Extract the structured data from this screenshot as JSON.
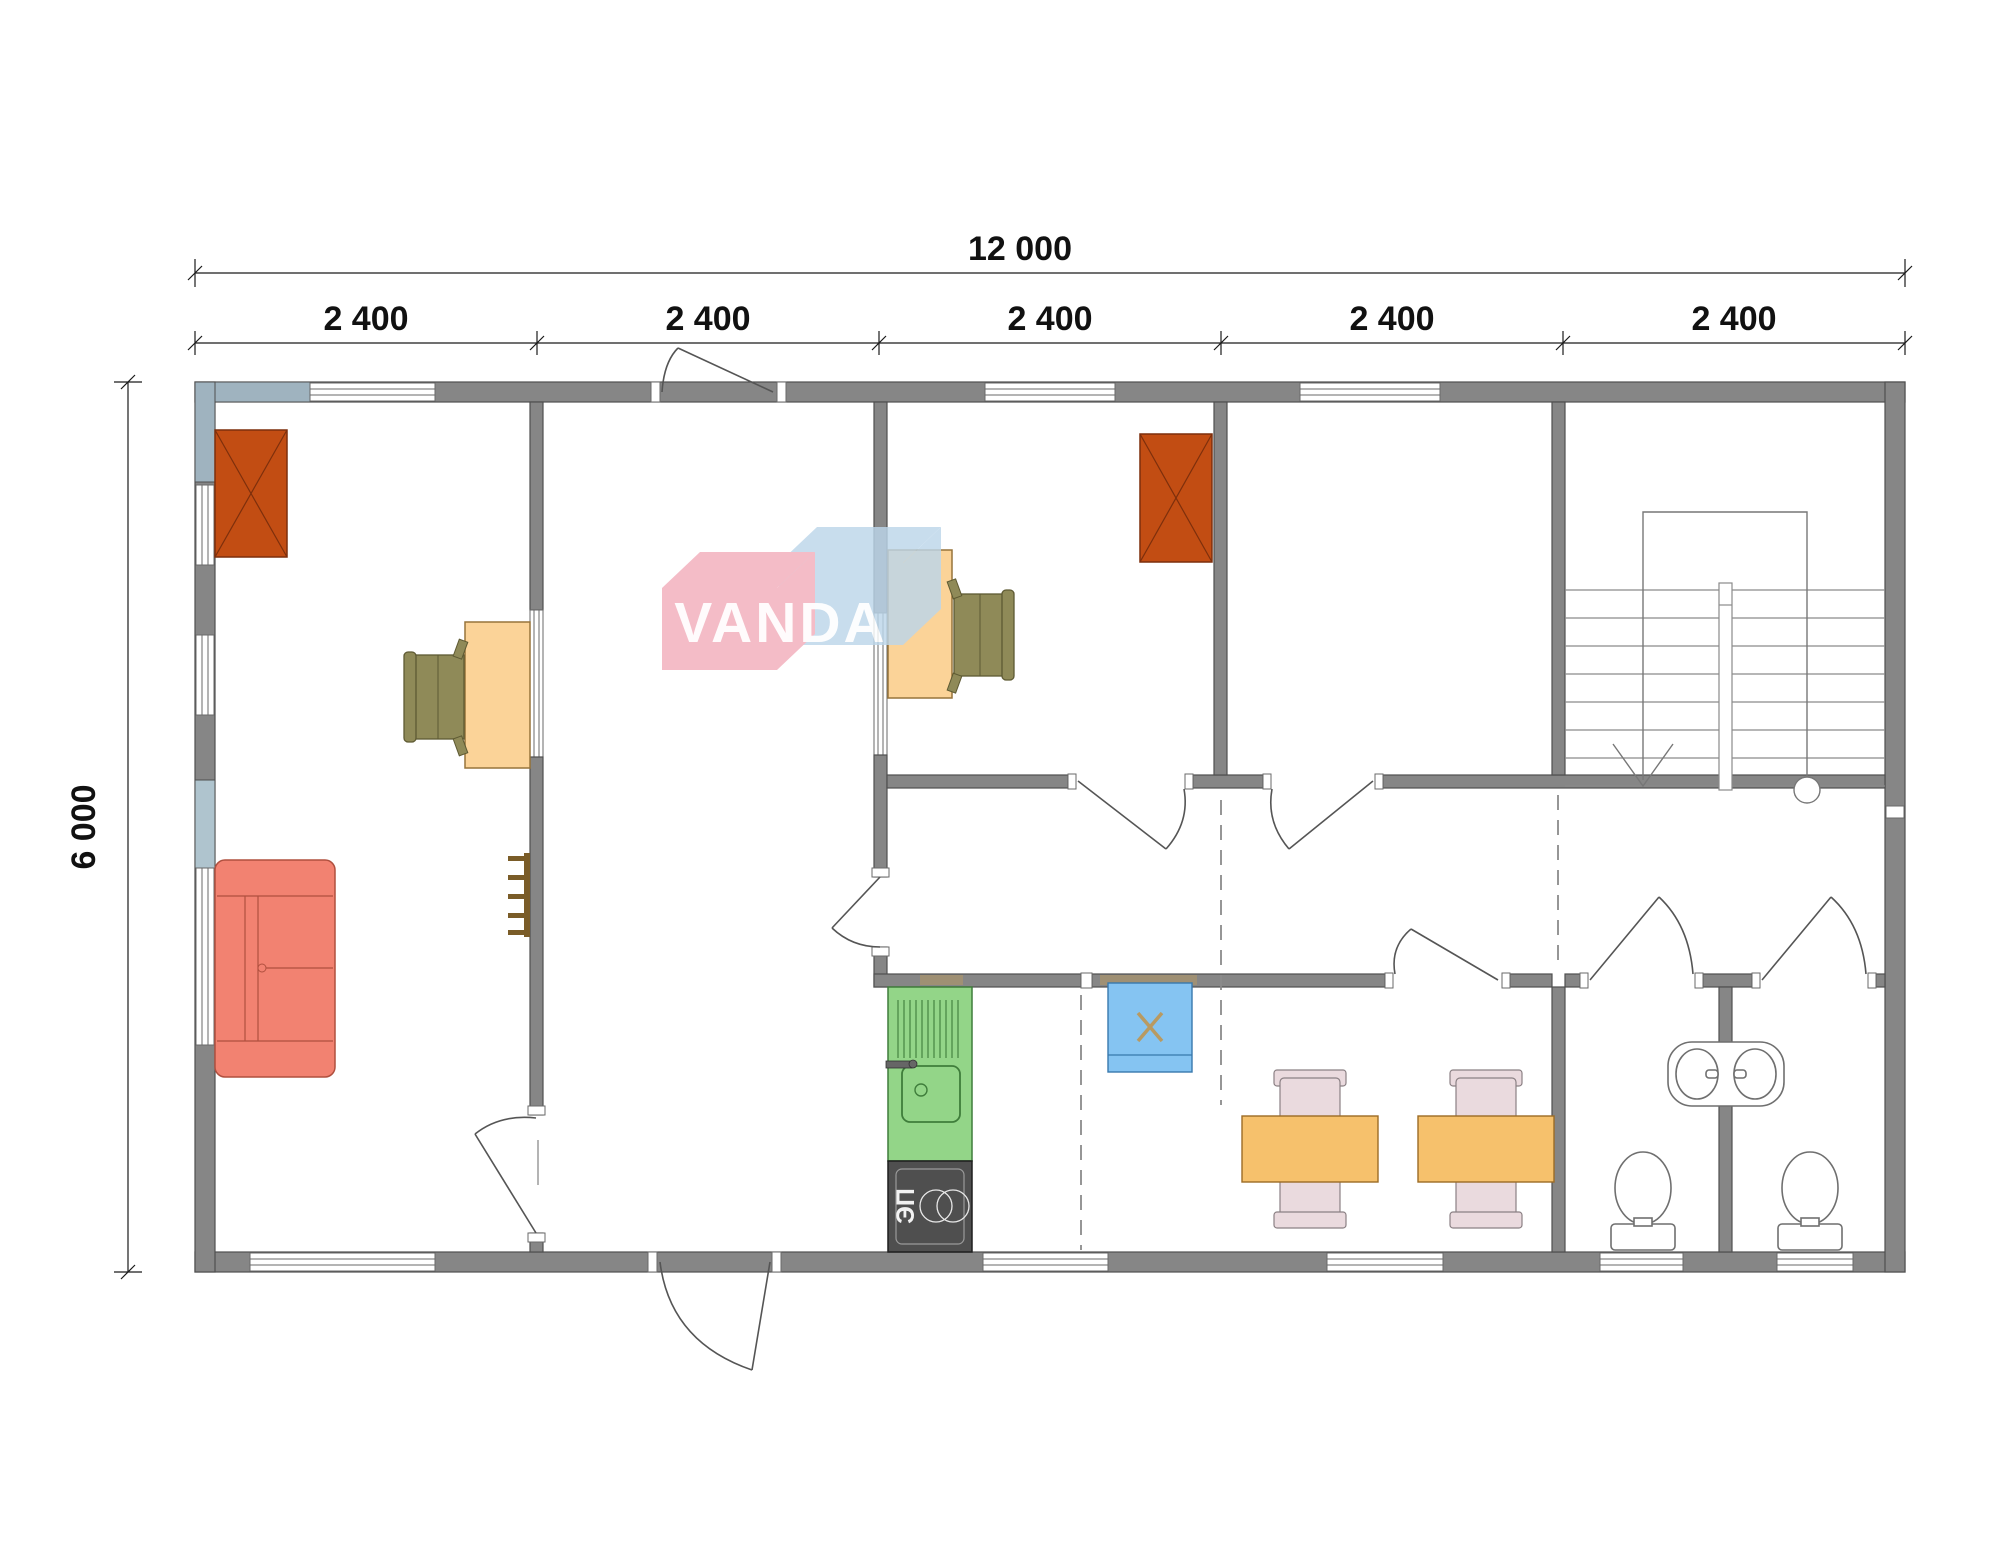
{
  "page": {
    "title": "VANDA modular building floor plan 12000 x 6000"
  },
  "dimensions": {
    "total_width": {
      "label": "12 000"
    },
    "bay_labels": [
      "2 400",
      "2 400",
      "2 400",
      "2 400",
      "2 400"
    ],
    "total_height": {
      "label": "6 000"
    }
  },
  "watermark": {
    "brand": "VANDA"
  },
  "kitchen": {
    "stove_label": "ЭП"
  },
  "rooms": {
    "living": "living-room",
    "hall": "entrance-hall",
    "study_1": "office-room-1",
    "study_2": "office-room-2",
    "corridor": "corridor",
    "kitchen_zone": "kitchen",
    "dining": "dining-room",
    "wc_left": "wc-1",
    "wc_right": "wc-2",
    "stairwell": "stairwell"
  },
  "colors": {
    "wall": "#868686",
    "wall_stroke": "#4f4f4f",
    "pier": "#9FB3BF",
    "pier_light": "#AFC4CE",
    "chimney": "#C24D13",
    "chimney_stroke": "#7d2f0c",
    "desk": "#FBD398",
    "desk_stroke": "#97743a",
    "chair_olive": "#8F8A58",
    "chair_olive_stroke": "#5e5a33",
    "sofa": "#F28271",
    "sofa_stroke": "#b0503f",
    "counter": "#93D588",
    "counter_stroke": "#3f7d3b",
    "stove": "#4F4F4F",
    "stove_stroke": "#1e1e1e",
    "fridge": "#85C4F2",
    "fridge_stroke": "#3879ad",
    "table": "#F6C16C",
    "table_stroke": "#9c6b25",
    "chair_pink": "#EADADE",
    "chair_pink_stroke": "#8b8084",
    "fixture_stroke": "#6f6f6f",
    "line": "#555555",
    "dash": "#8a8a8a",
    "dim": "#1a1a1a",
    "wood": "#7a5c28",
    "mark": "#b89a62",
    "logo_pink": "#F2AEBB",
    "logo_blue": "#BCD6EA"
  }
}
